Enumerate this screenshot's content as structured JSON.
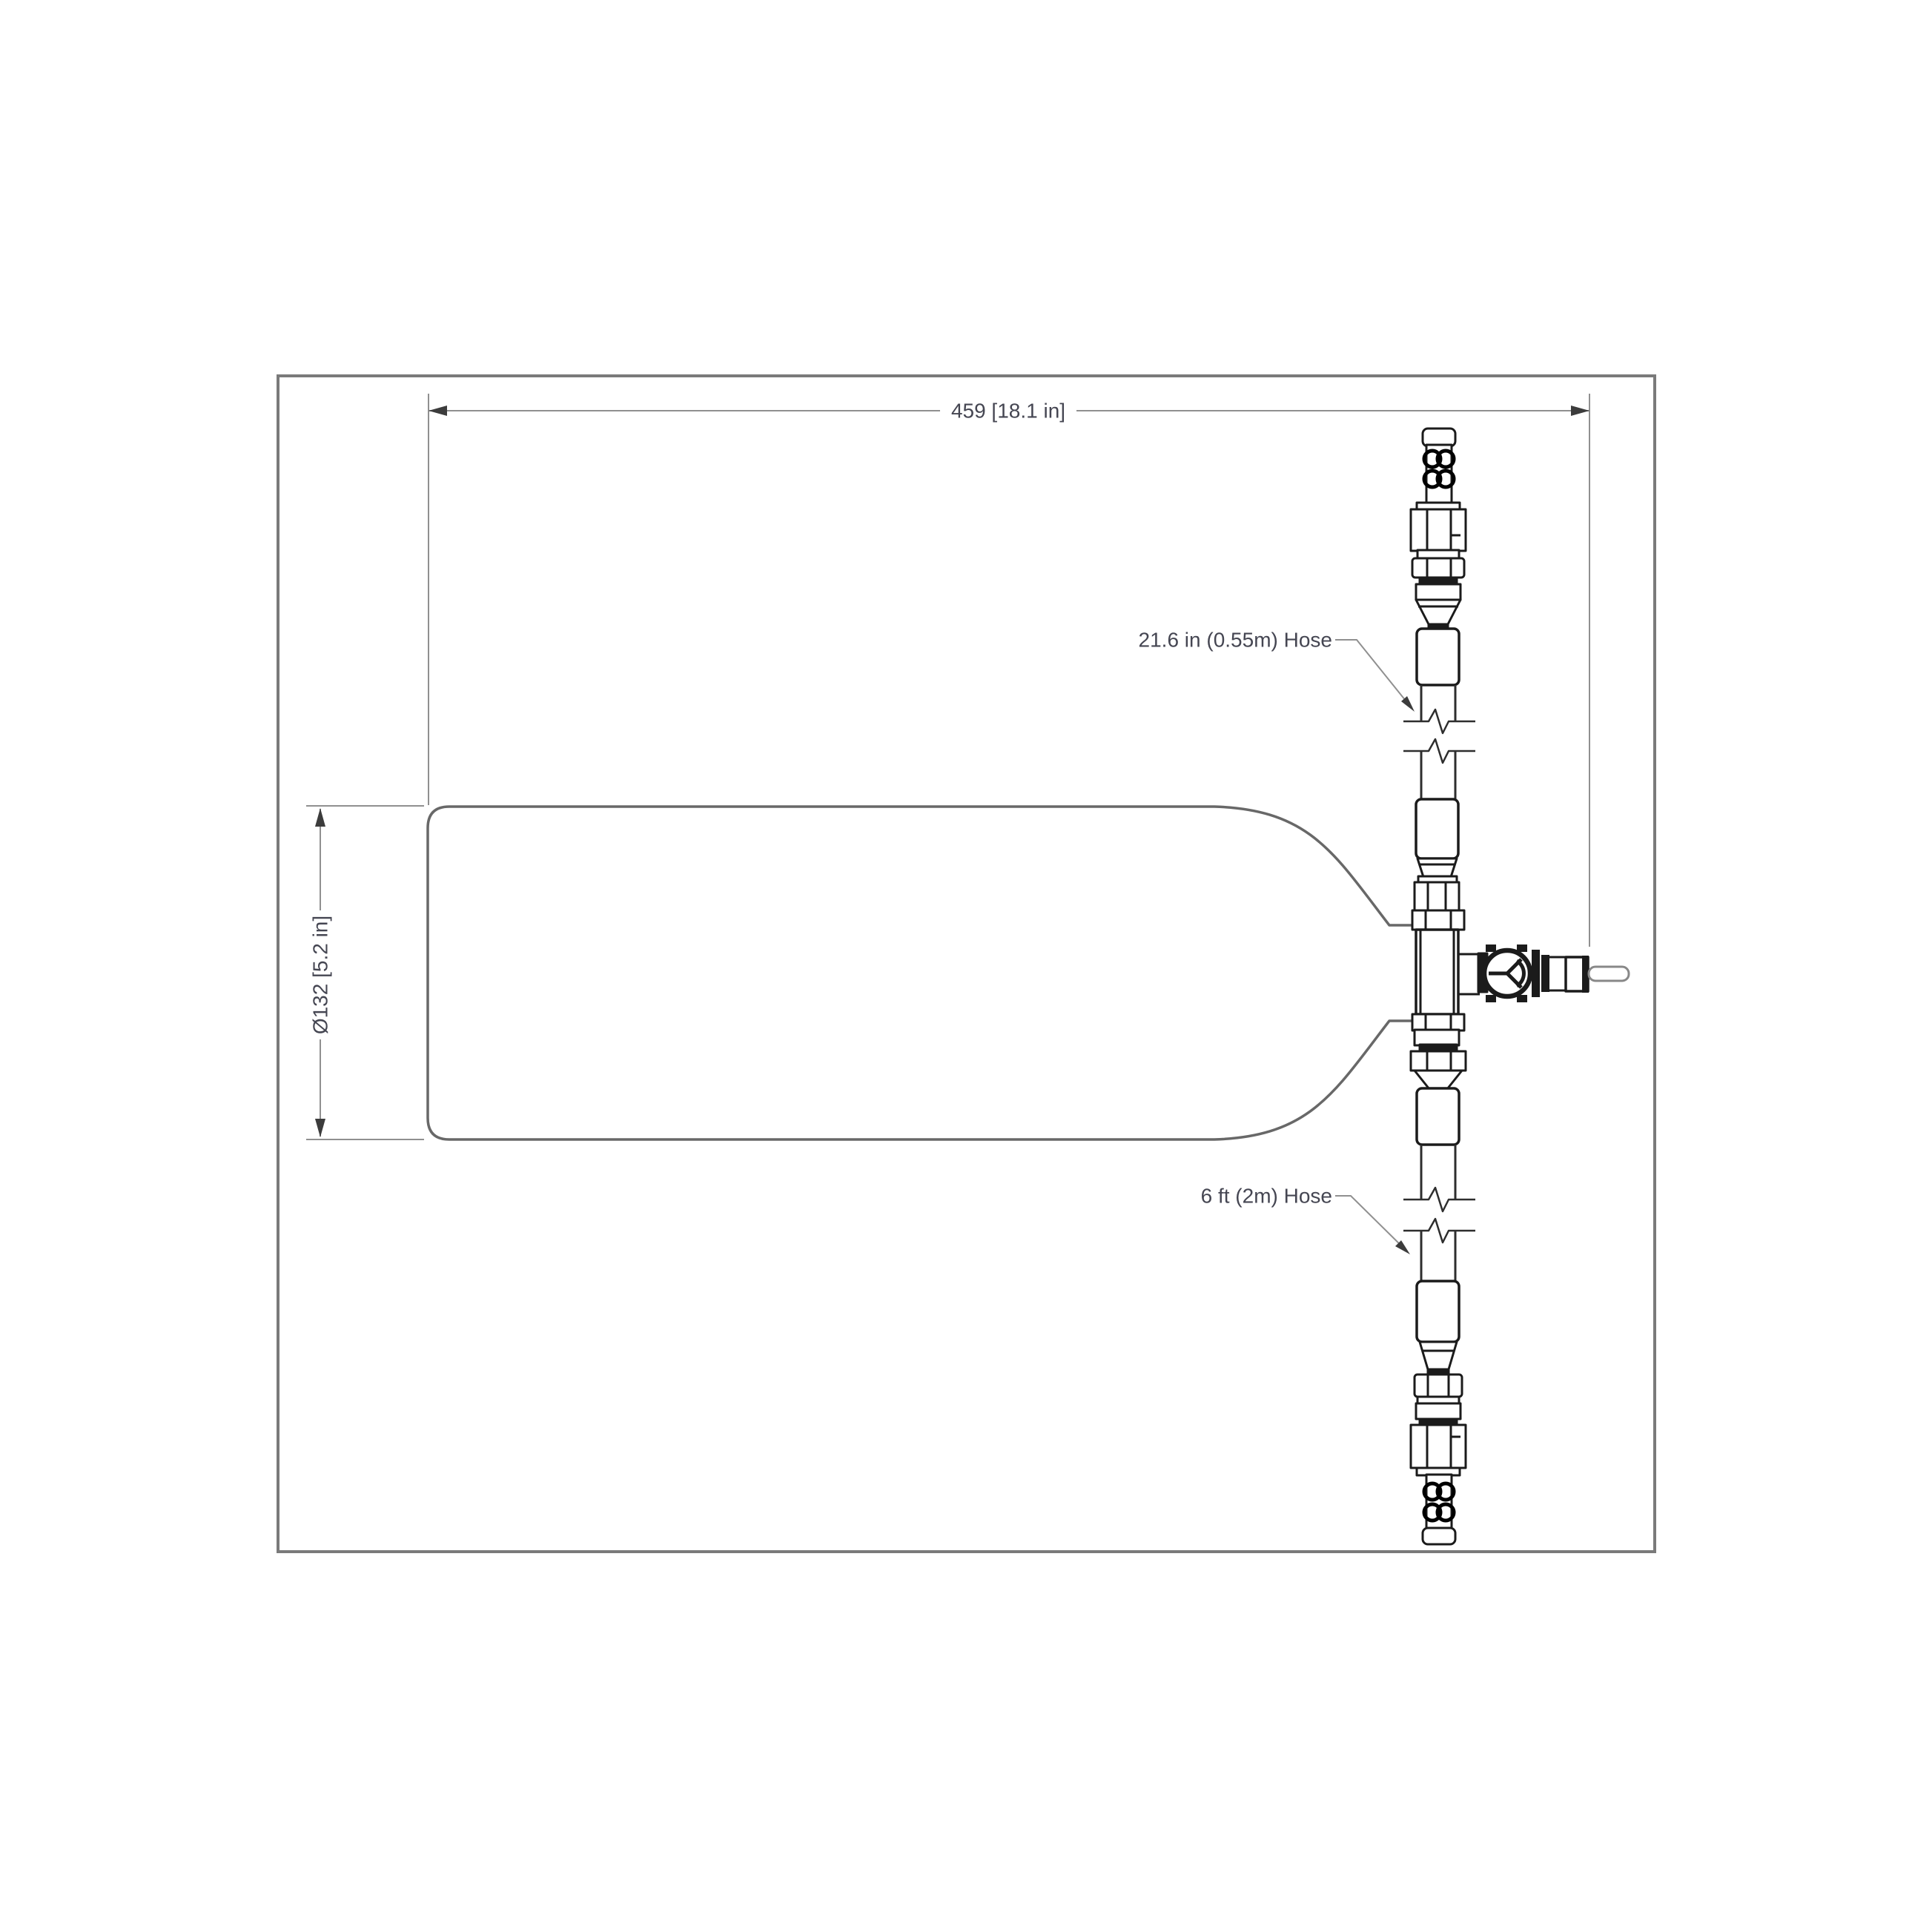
{
  "drawing": {
    "type": "engineering-dimension-drawing",
    "subject": "gas cylinder with regulator valve and hose assembly",
    "colors": {
      "background": "#ffffff",
      "frame_stroke": "#7a7a7a",
      "cylinder_stroke": "#686868",
      "fitting_stroke": "#1b1b1b",
      "hose_stroke": "#2e2e2e",
      "dimension_line": "#909090",
      "arrowhead": "#3c3c3c",
      "text": "#454652"
    },
    "dimensions": {
      "length": {
        "text": "459 [18.1 in]"
      },
      "diameter": {
        "text": "Ø132 [5.2 in]"
      }
    },
    "callouts": {
      "top_hose": {
        "text": "21.6 in (0.55m) Hose"
      },
      "bottom_hose": {
        "text": "6 ft (2m) Hose"
      }
    }
  }
}
